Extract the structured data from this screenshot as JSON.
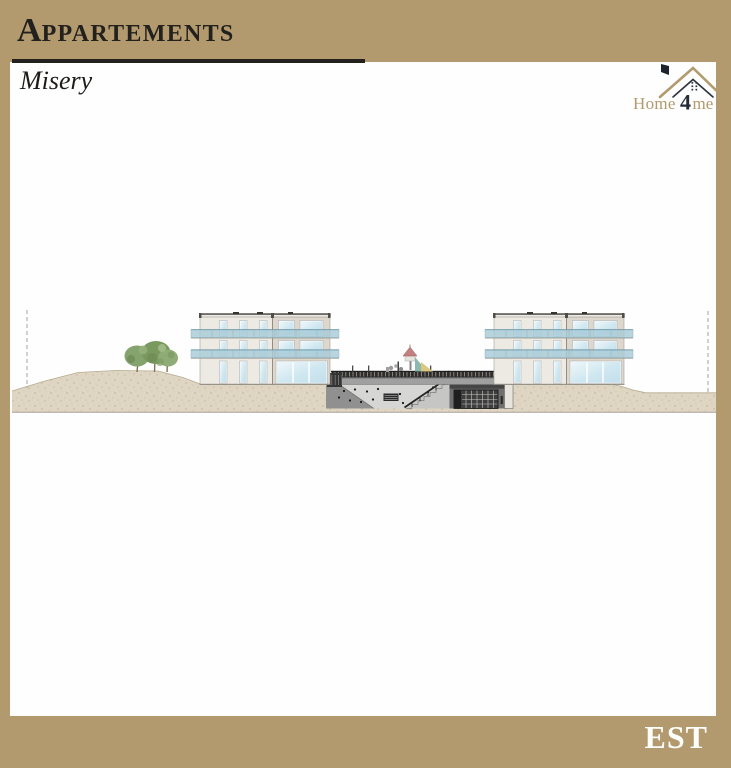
{
  "header": {
    "title_initial": "A",
    "title_rest": "ppartements",
    "subtitle": "Misery"
  },
  "logo": {
    "text_pre": "Home",
    "text_num": "4",
    "text_post": "me"
  },
  "footer": {
    "orientation_label": "EST"
  },
  "palette": {
    "frame_tan": "#b29a6e",
    "ink": "#23211d",
    "logo_dark": "#2a323e",
    "facade_light": "#edeae3",
    "facade_shaded": "#ddd7cd",
    "window_glass": "#cfe7f0",
    "balcony_glass": "#a9ccd9",
    "ground_beige": "#ded5c3",
    "concrete": "#6f6f6f",
    "railing_dark": "#2e2d2c",
    "tree_green": "#79995f",
    "playground_red": "#c47f7f",
    "playground_teal": "#7fb3aa",
    "playground_yellow": "#d9c87e"
  }
}
